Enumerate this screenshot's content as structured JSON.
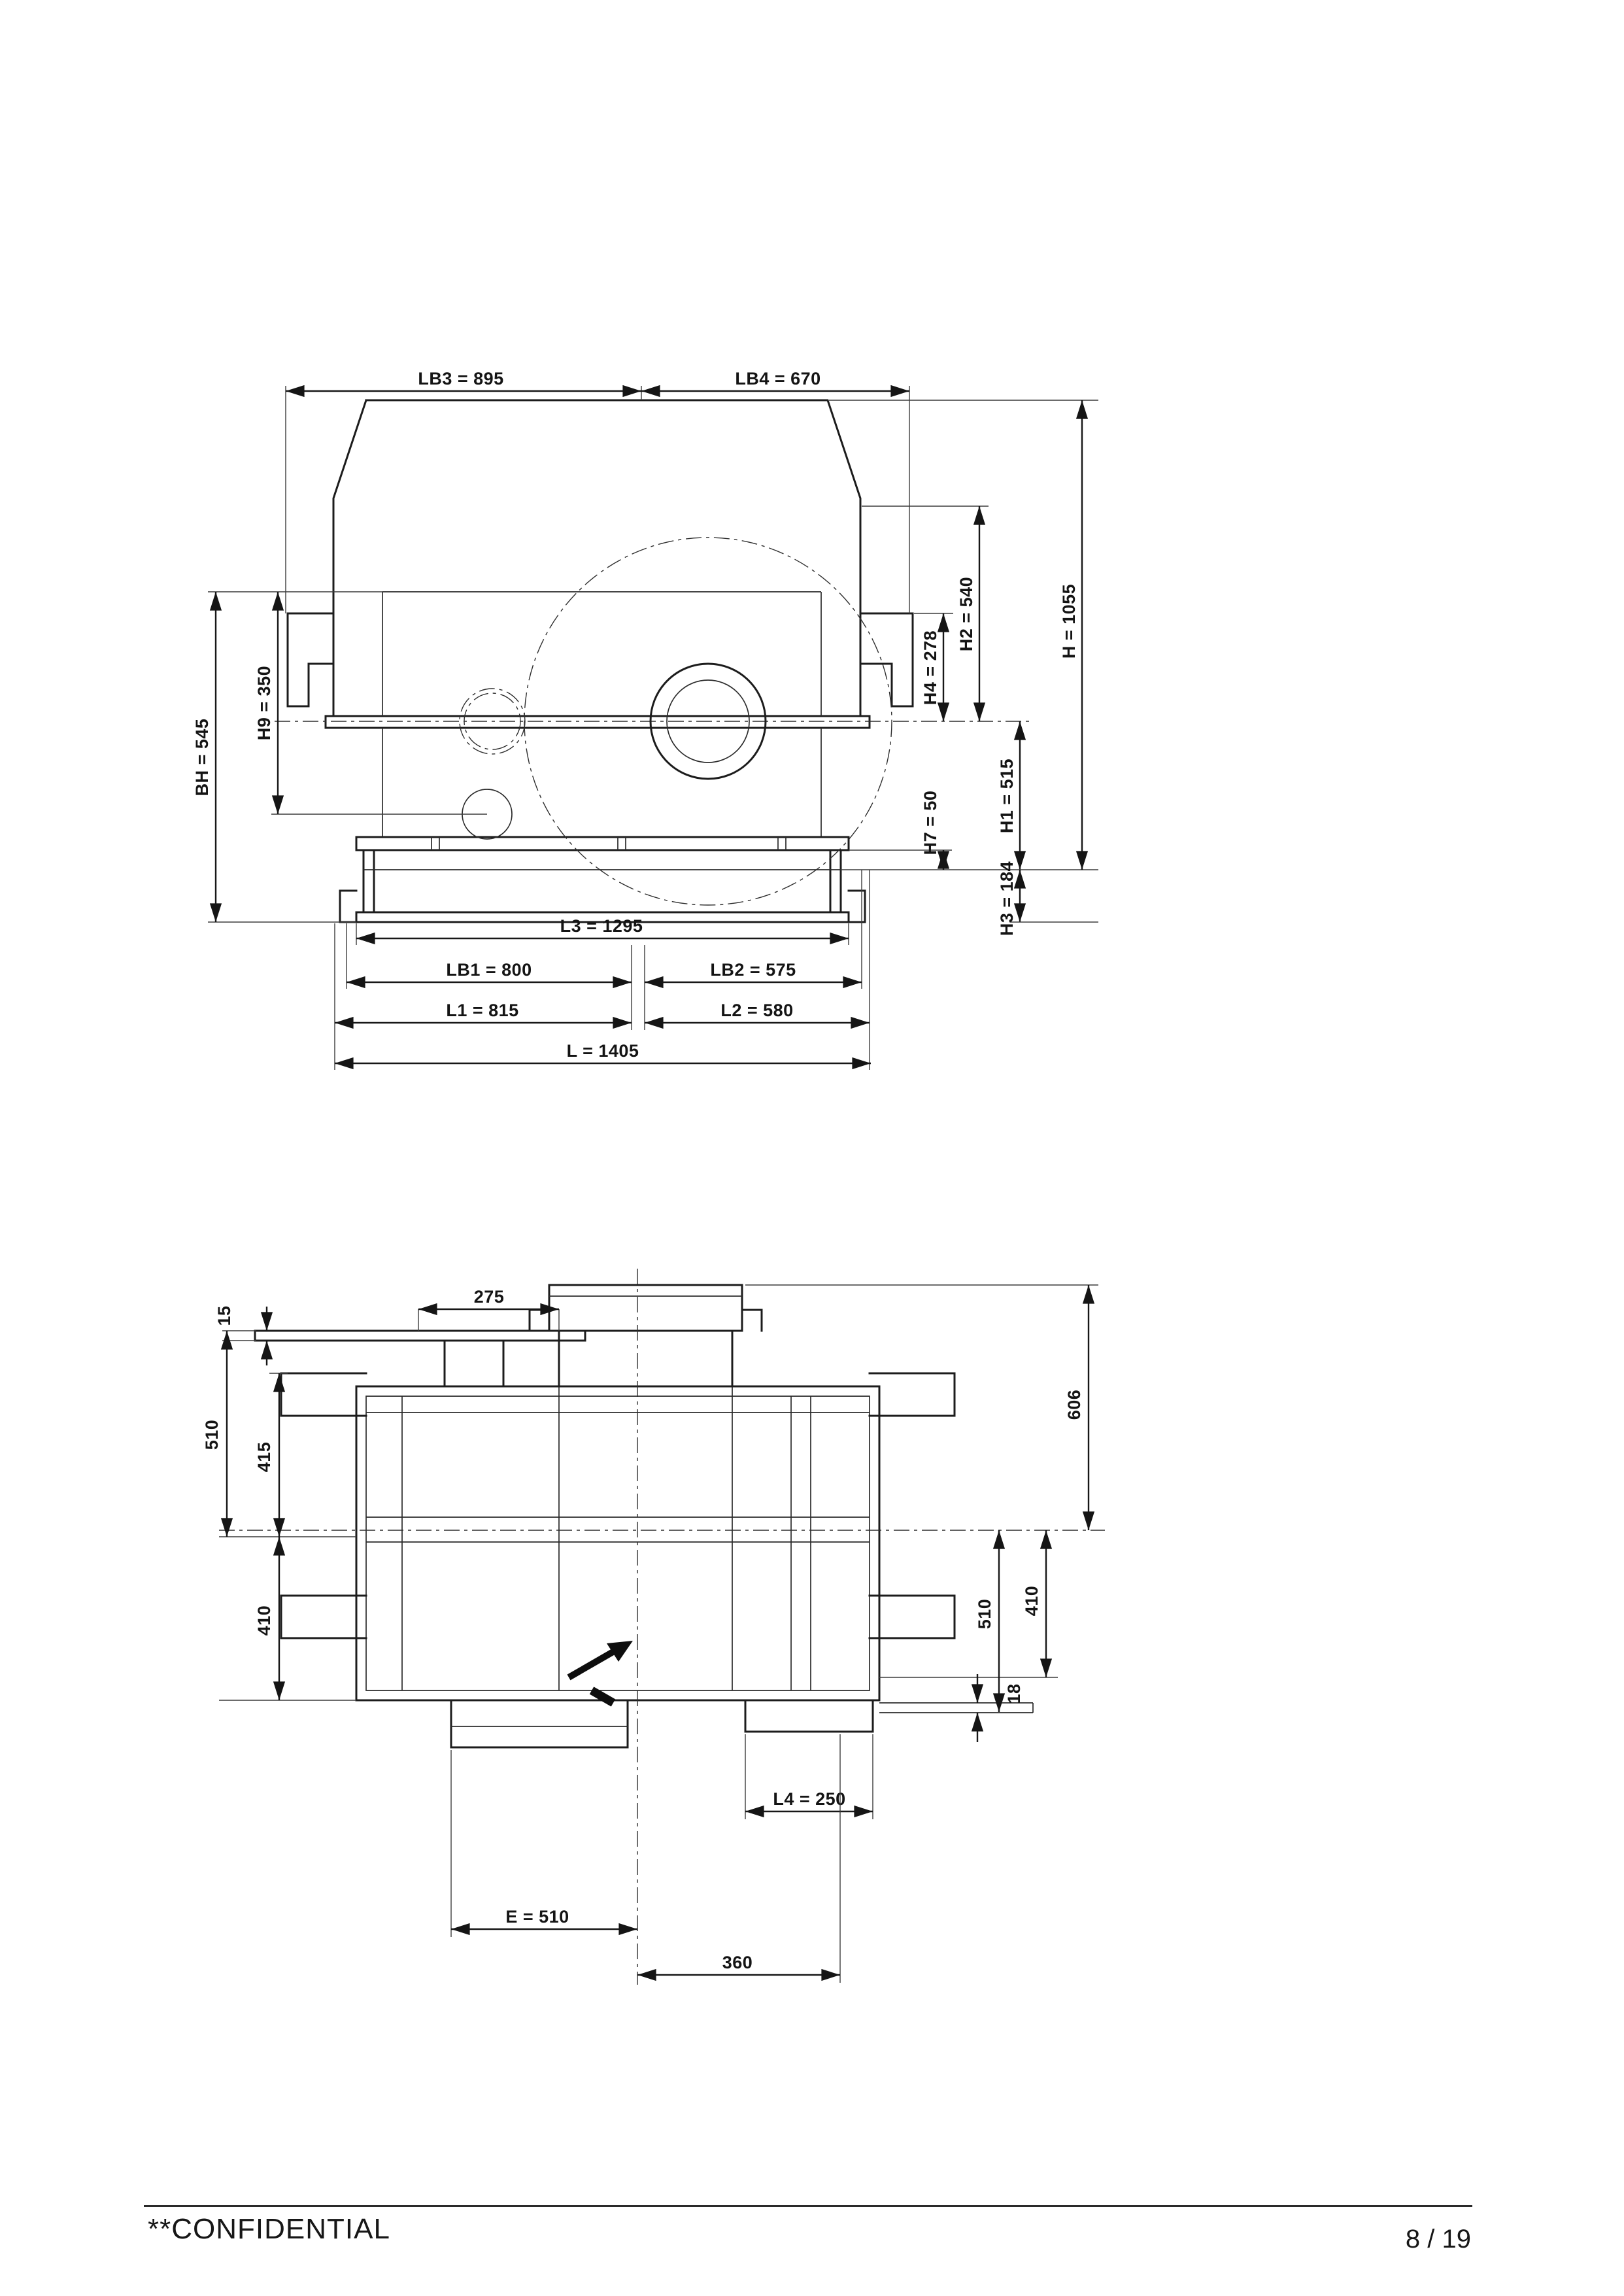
{
  "footer": {
    "confidential": "**CONFIDENTIAL",
    "page_number": "8 / 19"
  },
  "front_view": {
    "description": "gear unit front elevation",
    "dims": {
      "lb3": "LB3 = 895",
      "lb4": "LB4 = 670",
      "h4": "H4 = 278",
      "h2": "H2 = 540",
      "h": "H = 1055",
      "bh": "BH = 545",
      "h9": "H9 = 350",
      "h1": "H1 = 515",
      "h7": "H7 = 50",
      "h3": "H3 = 184",
      "l3": "L3 = 1295",
      "lb1": "LB1 = 800",
      "lb2": "LB2 = 575",
      "l1": "L1 = 815",
      "l2": "L2 = 580",
      "l": "L = 1405"
    }
  },
  "plan_view": {
    "description": "gear unit plan view",
    "dims": {
      "d275": "275",
      "d15": "15",
      "d510_left": "510",
      "d415": "415",
      "d410_left": "410",
      "d606": "606",
      "d510_right": "510",
      "d410_right": "410",
      "d18": "18",
      "l4": "L4 = 250",
      "e": "E = 510",
      "d360": "360"
    }
  }
}
